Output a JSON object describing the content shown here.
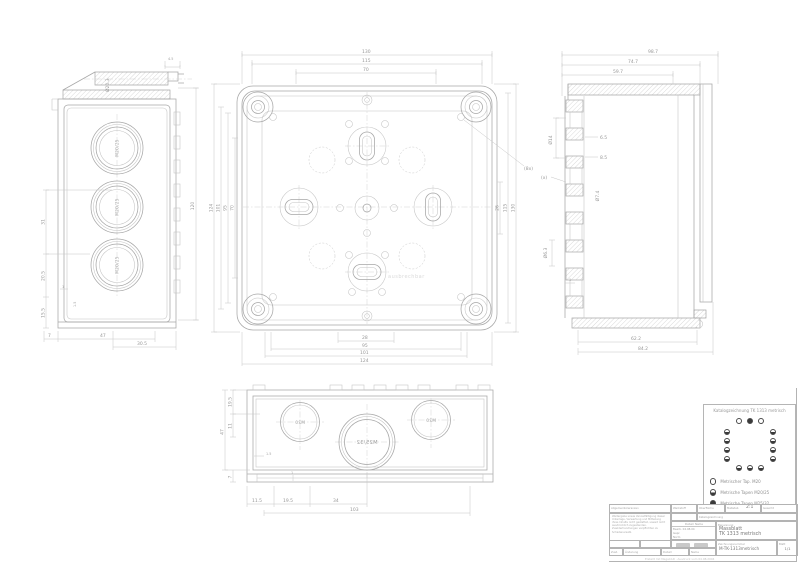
{
  "colors": {
    "line": "#a7a7a7",
    "dim_text": "#989898",
    "hatch": "#bdbdbd",
    "watermark": "#dadada",
    "legend_dot": "#3a3a3a"
  },
  "left_view": {
    "knockout": "M20/25",
    "dia_top": "Ø20.3",
    "d4_5": "4.5",
    "height": "120",
    "d31": "31",
    "d20_5": "20.5",
    "d15_5": "15.5",
    "d1": "1",
    "d1_5": "1.5",
    "d7": "7",
    "d47": "47",
    "d30_5": "30.5"
  },
  "front_view": {
    "top": [
      "130",
      "115",
      "70"
    ],
    "bottom": [
      "28",
      "95",
      "101",
      "124"
    ],
    "left": [
      "124",
      "101",
      "95",
      "70"
    ],
    "right": [
      "26",
      "115",
      "130"
    ],
    "note": "(8x)",
    "watermark": "ausbrechbar"
  },
  "section_view": {
    "top": [
      "98.7",
      "74.7",
      "59.7"
    ],
    "bottom": [
      "62.2",
      "84.2"
    ],
    "dia14": "Ø14",
    "d6_5": "6.5",
    "d8_5": "8.5",
    "x_note": "(x)",
    "dia7_4": "Ø7.4",
    "dia6_3": "Ø6.3",
    "d1": "1"
  },
  "bottom_view": {
    "m20": "M20",
    "m25_32": "M25/32",
    "d19_5": "19.5",
    "d11": "11",
    "d47": "47",
    "d7": "7",
    "d1_5": "1.5",
    "d1": "1",
    "b11_5": "11.5",
    "b19_5": "19.5",
    "b34": "34",
    "b103": "103"
  },
  "legend": {
    "title": "Katalogzeichnung TK 1313 metrisch",
    "items": [
      {
        "symbol": "open-circle",
        "label": "Metrischer Tap. M20"
      },
      {
        "symbol": "half-circle",
        "label": "Metrische Tapen M20/25"
      },
      {
        "symbol": "full-circle",
        "label": "Metrische Tapen M25/32"
      }
    ]
  },
  "titleblock": {
    "tol_label": "Allgemeintoleranzen",
    "werkstoff_label": "Werkstoff",
    "oberflaeche_label": "Oberfläche",
    "massstab_label": "Maßstab",
    "scale": "2:1",
    "gewicht_label": "Gewicht",
    "doc_type": "Katalogzeichnung",
    "note": "Weitergabe sowie Vervielfältigung dieser Unterlage, Verwertung und Mitteilung ihres Inhalts nicht gestattet, soweit nicht ausdrücklich zugestanden. Zuwiderhandlungen verpflichten zu Schadenersatz.",
    "datum_label": "Datum",
    "name_label": "Name",
    "bearb_label": "Bearb.",
    "gepr_label": "Gepr.",
    "norm_label": "Norm",
    "bearb_datum": "04.08.04",
    "benennung_label": "Benennung",
    "title_line1": "Massblatt",
    "title_line2": "TK 1313 metrisch",
    "zeichnung_label": "Zeichnungsnummer",
    "drawing_no": "M-TK-1313metrisch",
    "blatt_label": "Blatt",
    "blatt_value": "1/1",
    "zust_label": "Zust.",
    "aenderung_label": "Änderung",
    "footer": "Erstellt mit MegaCAD · Ausdruck vom 04.08.2004"
  }
}
